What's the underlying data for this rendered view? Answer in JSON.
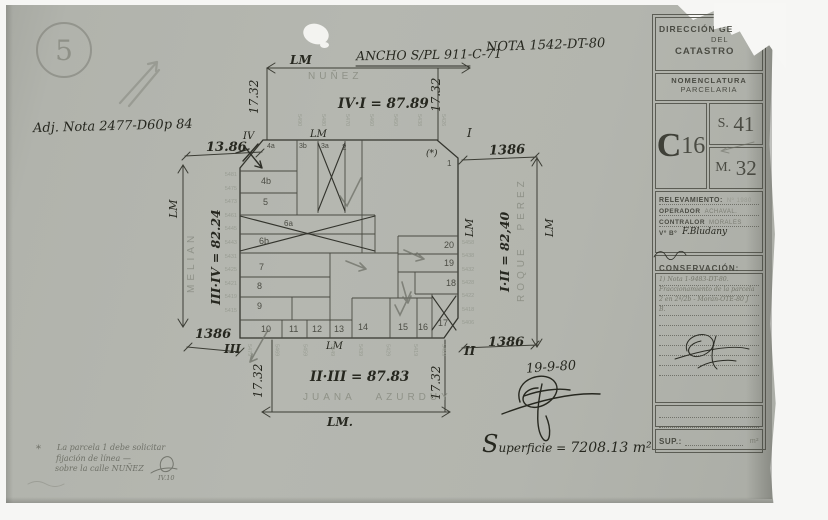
{
  "sheet": {
    "number": "5"
  },
  "annotations": {
    "adj_nota": "Adj. Nota 2477-D60p 84",
    "ancho": "ANCHO S/PL 911-C-71",
    "nota": "NOTA 1542-DT-80",
    "date": "19-9-80",
    "superficie_cap": "S",
    "superficie_rest": "uperficie =",
    "superficie_value": "7208.13 m²",
    "footnote_star": "*",
    "footnote_line1": "La parcela 1 debe solicitar",
    "footnote_line2": "fijación de línea —",
    "footnote_line3": "sobre la calle NUÑEZ",
    "footnote_ref": "IV.10"
  },
  "plan": {
    "lm": "LM",
    "lm_dot": "LM.",
    "streets": {
      "top": "NUÑEZ",
      "bottom": "JUANA AZURDUY",
      "left": "MELIAN",
      "right": "ROQUE PEREZ"
    },
    "dims": {
      "top": "IV·I = 87.89",
      "bottom": "II·III = 87.83",
      "left": "III·IV = 82.24",
      "right": "I·II = 82,40",
      "v": "17.32",
      "tl": "13.86",
      "d1386": "1386"
    },
    "corners": {
      "tl": "IV",
      "tr": "I",
      "br": "II",
      "bl": "III"
    },
    "star": "(*)",
    "parcels": {
      "p1": "1",
      "p2": "2",
      "p3a": "3a",
      "p3b": "3b",
      "p4a": "4a",
      "p4b": "4b",
      "p5": "5",
      "p6a": "6a",
      "p6b": "6b",
      "p7": "7",
      "p8": "8",
      "p9": "9",
      "p10": "10",
      "p11": "11",
      "p12": "12",
      "p13": "13",
      "p14": "14",
      "p15": "15",
      "p16": "16",
      "p17": "17",
      "p18": "18",
      "p19": "19",
      "p20": "20"
    },
    "lots_left": [
      "5481",
      "5475",
      "5473",
      "5461",
      "5445",
      "5443",
      "5431",
      "5425",
      "5421",
      "5419",
      "5415"
    ],
    "lots_right": [
      "5458",
      "5438",
      "5432",
      "5428",
      "5422",
      "5418",
      "5406"
    ],
    "lots_top": [
      "5490",
      "5480",
      "5470",
      "5460",
      "5450",
      "5438",
      "5426"
    ],
    "lots_bottom": [
      "5479",
      "5469",
      "5459",
      "5449",
      "5439",
      "5429",
      "5419",
      "5409"
    ]
  },
  "titleblock": {
    "header1": "DIRECCIÓN GE",
    "header1b": "DEL",
    "header1c": "CATASTRO",
    "header2a": "NOMENCLATURA",
    "header2b": "PARCELARIA",
    "circ": "C",
    "circ_n": "16",
    "s": "S.",
    "s_n": "41",
    "m": "M.",
    "m_n": "32",
    "relevamiento": "RELEVAMIENTO:",
    "relevamiento_no": "Nº 1980",
    "operador": "OPERADOR",
    "operador_v": "ACHAVAL.",
    "contralor": "CONTRALOR",
    "contralor_v": "MORALES",
    "vobo": "Vº Bº",
    "vobo_v": "F.Bludany",
    "conservacion": "CONSERVACIÓN:",
    "nota1": "1) Nota 1-9483-DT-80.",
    "nota2": "Fraccionamiento de la parcela",
    "nota3": "2 en 2ª/2b - Morán-OTE-80 J",
    "nota4": "B.",
    "sup": "SUP.:",
    "sup_unit": "m²"
  }
}
